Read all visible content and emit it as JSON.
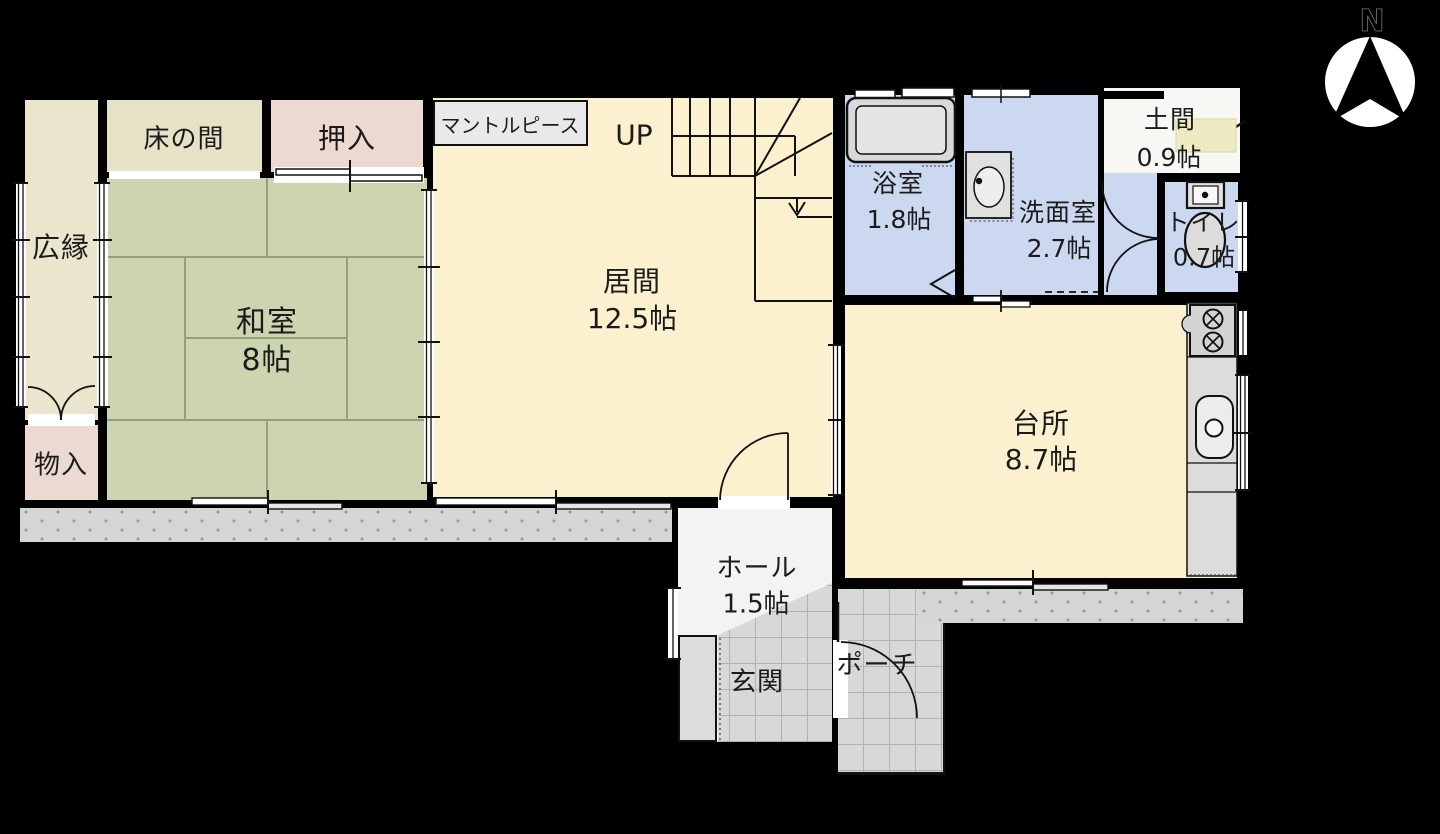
{
  "compass": {
    "label": "N"
  },
  "annotations": {
    "mantelpiece": "マントルピース",
    "stairs_up": "UP"
  },
  "rooms": {
    "hiroen": {
      "name": "広縁"
    },
    "tokonoma": {
      "name": "床の間"
    },
    "oshiire": {
      "name": "押入"
    },
    "washitsu": {
      "name": "和室",
      "size": "8帖"
    },
    "monoire": {
      "name": "物入"
    },
    "ima": {
      "name": "居間",
      "size": "12.5帖"
    },
    "yokushitsu": {
      "name": "浴室",
      "size": "1.8帖"
    },
    "senmenshitsu": {
      "name": "洗面室",
      "size": "2.7帖"
    },
    "doma": {
      "name": "土間",
      "size": "0.9帖"
    },
    "toire": {
      "name": "トイレ",
      "size": "0.7帖"
    },
    "daidokoro": {
      "name": "台所",
      "size": "8.7帖"
    },
    "hall": {
      "name": "ホール",
      "size": "1.5帖"
    },
    "genkan": {
      "name": "玄関"
    },
    "porch": {
      "name": "ポーチ"
    }
  },
  "colors": {
    "background": "#000000",
    "wall": "#000000",
    "wood_floor": "#fbf1ce",
    "floor_line": "#eee0b6",
    "tatami_green": "#ccd4b0",
    "tatami_line": "#94a07a",
    "closet_pink": "#ecd9d1",
    "veranda_cream": "#e9e6cd",
    "tokonoma_beige": "#e6e2c6",
    "wet_area_blue": "#ccd7f0",
    "doma_white": "#f7f7f4",
    "doma_mat": "#eeebc2",
    "tile_gray": "#d8d8d8",
    "deck_gray": "#d5d5d5",
    "counter_gray": "#dcdcdc",
    "label_box_gray": "#e9e9e9"
  }
}
